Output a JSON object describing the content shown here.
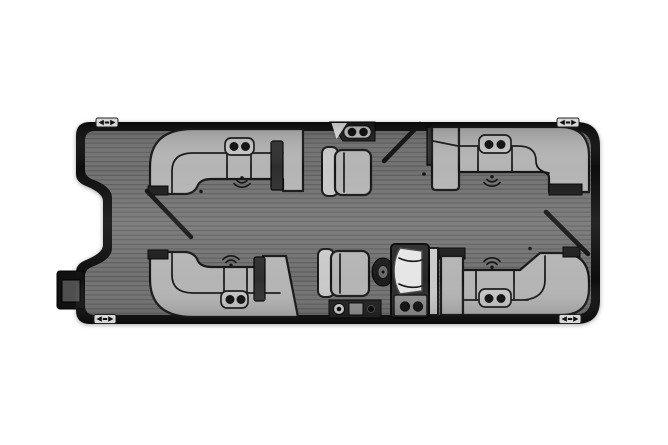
{
  "meta": {
    "title": "Pontoon Boat Floor Plan (Top View)",
    "description": "Top-down floor plan diagram of a pontoon boat with four wraparound lounges, helm console with captain chair, recliner chair, three open swing gates, four mooring cleats and a stern outboard motor",
    "orientation": "bow-right"
  },
  "colors": {
    "background": "#ffffff",
    "hull": "#0d0d0d",
    "deck": "#717171",
    "plank_line": "#5a5a5a",
    "furniture_fill": "#b4b4b4",
    "furniture_light": "#c9c9c9",
    "furniture_outline": "#141414",
    "armrest": "#2e2e2e",
    "cup_holder": "#0a0a0a",
    "tray": "#c6c6c6",
    "console_body": "#262626",
    "windshield": "#e6e6e6",
    "console_base": "#8d8d8d",
    "wheel": "#1b1b1b",
    "motor": "#111111",
    "motor_inner": "#4f4f4f",
    "cleat": "#d8d8d8"
  },
  "boat": {
    "deck_finish": "horizontal-plank-flooring",
    "seating": {
      "lounges": [
        {
          "id": "lounge-top-left",
          "position": "top-left",
          "shape": "wraparound-L",
          "cup_holders": 2,
          "speaker": true,
          "armrest": true
        },
        {
          "id": "lounge-top-right",
          "position": "top-right",
          "shape": "wraparound-L",
          "cup_holders": 2,
          "speaker": true,
          "armrest": false
        },
        {
          "id": "lounge-bottom-left",
          "position": "bottom-left",
          "shape": "wraparound-L",
          "cup_holders": 2,
          "speaker": true,
          "armrest": true
        },
        {
          "id": "lounge-bottom-right",
          "position": "bottom-right",
          "shape": "wraparound-L",
          "cup_holders": 2,
          "speaker": true,
          "armrest": false
        }
      ],
      "chairs": [
        {
          "id": "recliner-chair",
          "position": "top-center"
        },
        {
          "id": "captain-chair",
          "position": "bottom-center",
          "at_helm": true
        }
      ]
    },
    "helm": {
      "console": true,
      "windshield": true,
      "steering_wheel": true,
      "cup_holders": 2
    },
    "accessories": [
      {
        "id": "rail-table",
        "position": "top-center-rail",
        "cup_holders": 2
      },
      {
        "id": "stern-step-storage",
        "position": "bottom-center",
        "cup_holders": 1
      }
    ],
    "gates": [
      {
        "id": "gate-stern",
        "side": "left",
        "state": "open"
      },
      {
        "id": "gate-port",
        "side": "top",
        "state": "open"
      },
      {
        "id": "gate-bow",
        "side": "right",
        "state": "open"
      }
    ],
    "speakers": 4,
    "cleats": 4,
    "motor": {
      "id": "outboard-motor",
      "position": "stern-left"
    }
  }
}
